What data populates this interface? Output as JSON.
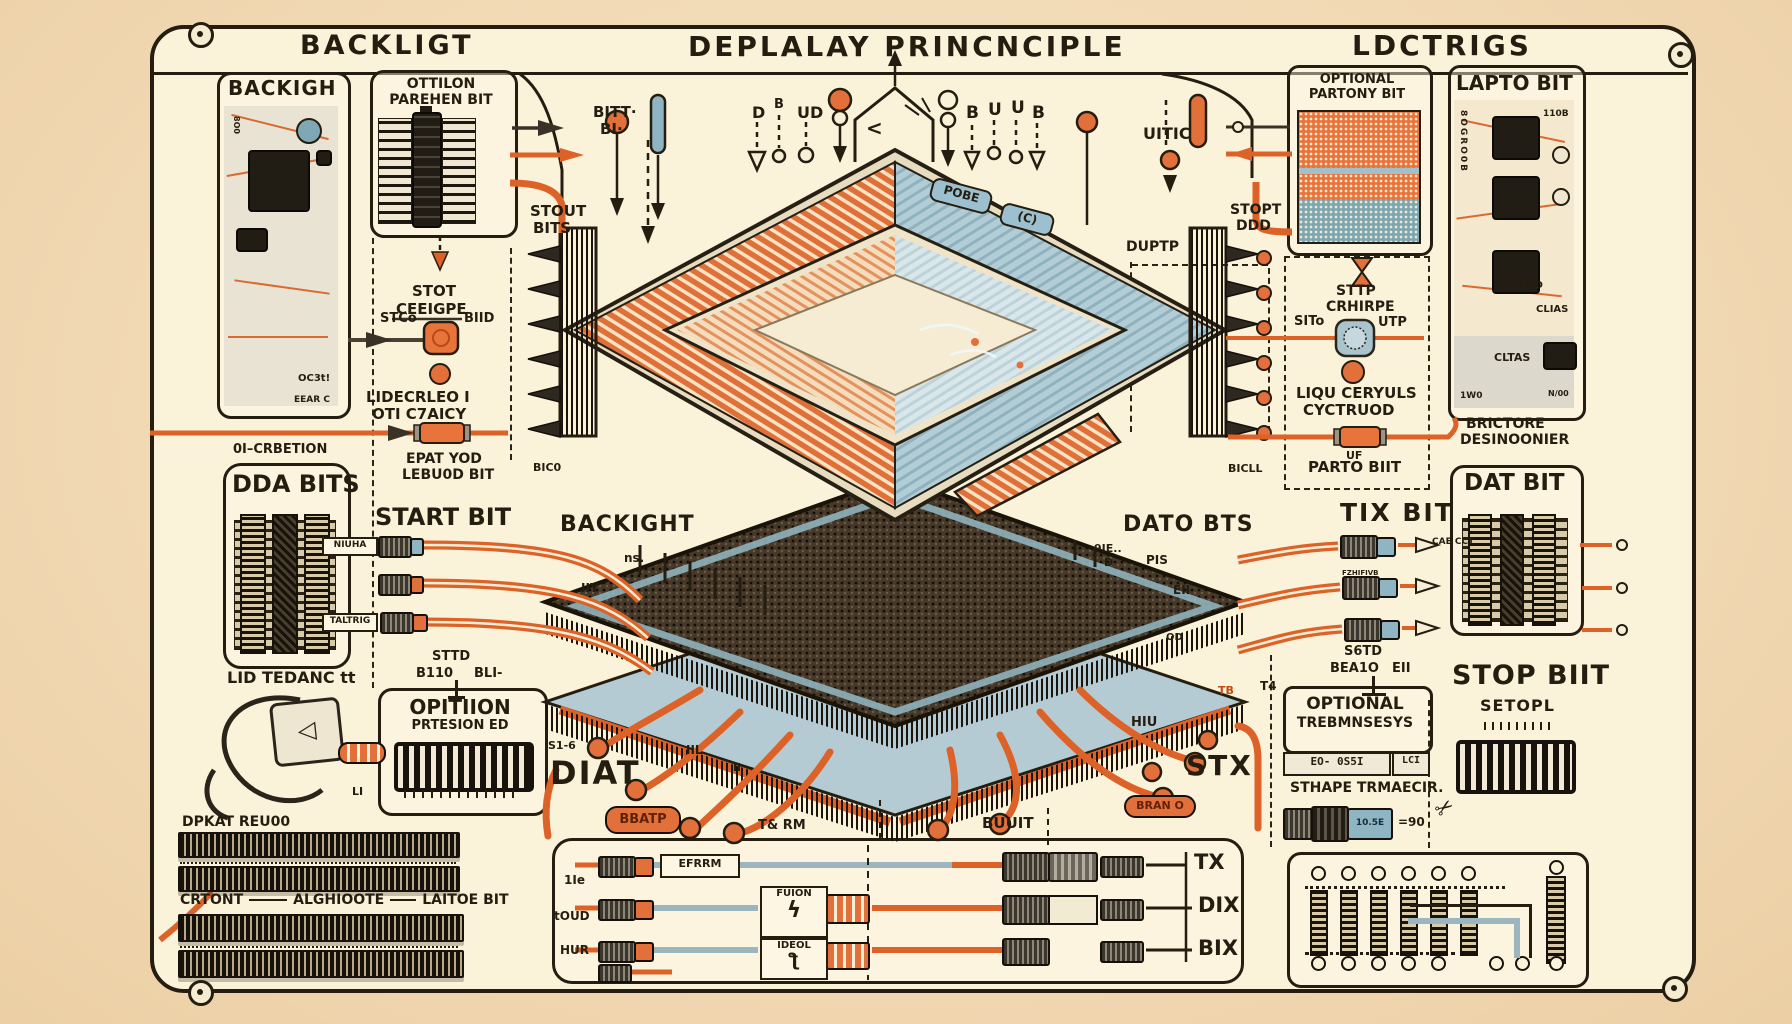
{
  "header": {
    "left": "BACKLIGT",
    "center": "DEPLALAY PRINCNCIPLE",
    "right": "LDCTRIGS"
  },
  "top": {
    "bitt": "BITT·",
    "bi": "BI·",
    "d": "D",
    "b_sup": "B",
    "ud": "UD",
    "b2": "B",
    "u1": "U",
    "u2": "U",
    "b3": "B",
    "uitic": "UITIC",
    "stout": "STOUT",
    "stout2": "BITS",
    "stopt": "STOPT",
    "stopt2": "DDD",
    "chev": "<",
    "pobe": "POBE",
    "cd": "(C)",
    "duptp": "DUPTP"
  },
  "left": {
    "backigh": "BACKIGH",
    "oc3t": "OC3t!",
    "eear": "EEAR C",
    "o6o": "8O0",
    "ottilon": "OTTILON",
    "parehen": "PAREHEN BIT",
    "stot": "STOT",
    "ceeigpe": "CEEIGPE",
    "stco": "STCo",
    "biid": "BIID",
    "lidecrleo": "LIDECRLEO I",
    "oticaicy": "OTI C7AICY",
    "oicrbetion": "0I–CRBETION",
    "epat": "EPAT YOD",
    "lebuod": "LEBU0D BIT",
    "dda": "DDA BITS",
    "start": "START BIT",
    "niuha": "NIUHA",
    "taltrig": "TALTRIG",
    "sttd": "STTD",
    "b110": "B110",
    "bli": "BLI-",
    "lid": "LID TEDANC tt",
    "li": "LI",
    "opitiion": "OPITIION",
    "prtesion": "PRTESION ED",
    "dpkat": "DPKAT REU00",
    "crtont": "CRTONT",
    "alghoote": "ALGHIOOTE",
    "laitoe": "LAITOE BIT"
  },
  "center": {
    "backight": "BACKIGHT",
    "ns": "ns.",
    "bic0": "BIC0",
    "iiy": "IIY",
    "dato": "DATO BTS",
    "die": "9IE..",
    "dd": "D",
    "pis": "PIS",
    "eii": "EII",
    "bicll": "BICLL",
    "tb": "TB",
    "qd": "QD",
    "s16": "S1-6",
    "diat": "DIAT",
    "bbatp": "BBATP",
    "txrm": "T& RM",
    "iil": "IIL",
    "il": "Il",
    "buuit": "BUUIT",
    "hiu": "HIU",
    "stx": "STX",
    "bran": "BRAN O"
  },
  "bottom": {
    "l1": "1Ie",
    "l2": "tOUD",
    "l3": "HUR",
    "efrrm": "EFRRM",
    "fuion": "FUION",
    "ideol": "IDEOL",
    "tx": "TX",
    "dix": "DIX",
    "bix": "BIX"
  },
  "right": {
    "partony1": "OPTIONAL",
    "partony2": "PARTONY BIT",
    "lapto": "LAPTO BIT",
    "clias": "CLIAS",
    "sieed": "SIEED",
    "b110": "110B",
    "w0": "1W0",
    "noo": "N/00",
    "vert": "8OGRO0B",
    "cltas": "CLTAS",
    "sttp": "STTP",
    "crhirpe": "CRHIRPE",
    "sito": "SITo",
    "utp": "UTP",
    "liqu": "LIQU CERYULS",
    "cyctruod": "CYCTRUOD",
    "uf": "UF",
    "parto": "PARTO BIIT",
    "brictore": "BRICTORE",
    "desinoover": "DESINOONIER",
    "tixbit": "TIX BIT",
    "caecct": "CAE CCT",
    "fzh": "FZHIFIVB",
    "datbit": "DAT BIT",
    "s6td": "S6TD",
    "bea1o": "BEA1O",
    "eii": "EII",
    "t4": "T4",
    "optional": "OPTIONAL",
    "trebmnsesys": "TREBMNSESYS",
    "lcd1": "EO- 0S5I",
    "lcd2": "LCI",
    "stape": "STHAPE TRMAECIR.",
    "n90": "=90",
    "e105": "10.5E",
    "stopbit": "STOP BIIT",
    "setopl": "SETOPL"
  },
  "icons": {
    "plug": "◁",
    "fuion": "ϟ",
    "ideol": "ƪ",
    "scissors": "✂"
  }
}
